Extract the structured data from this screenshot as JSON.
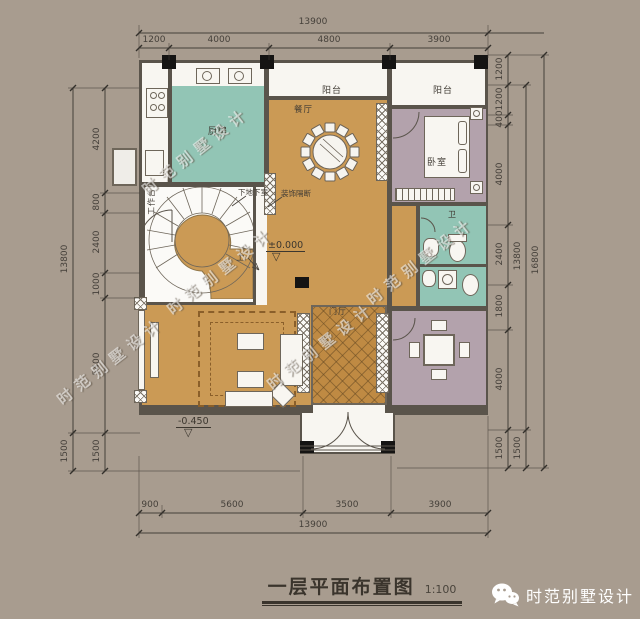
{
  "title": {
    "text": "一层平面布置图",
    "scale": "1:100"
  },
  "footer": {
    "brand": "时范别墅设计",
    "icon": "wechat-icon"
  },
  "watermark": {
    "text": "时范别墅设计"
  },
  "rooms": {
    "worktop": "工作台",
    "kitchen": "厨房",
    "dining": "餐厅",
    "balcony_top": "阳台",
    "balcony_right": "阳台",
    "bedroom": "卧室",
    "bath": "卫",
    "foyer": "门厅",
    "up": "上"
  },
  "annotations": {
    "to_basement": "下地下室",
    "partition": "装饰隔断",
    "level_zero": "±0.000",
    "level_entry": "-0.450",
    "level_symbol": "▽"
  },
  "dimensions": {
    "top": {
      "overall": "13900",
      "segments": [
        "1200",
        "4000",
        "4800",
        "3900"
      ]
    },
    "bottom": {
      "overall": "13900",
      "segments": [
        "900",
        "5600",
        "3500",
        "3900"
      ]
    },
    "left": {
      "overall": "13800",
      "porch": "1500",
      "segments": [
        "4200",
        "800",
        "2400",
        "1000",
        "5400",
        "1500"
      ]
    },
    "right": {
      "overall": "16800",
      "middle": "13800",
      "middle_porch": "1500",
      "segments": [
        "1200",
        "1200",
        "400",
        "4000",
        "2400",
        "1800",
        "4000",
        "1500"
      ]
    }
  },
  "colors": {
    "background": "#a89c8f",
    "floor": "#cb9a55",
    "wet_room": "#92c5b5",
    "soft_room": "#b3a2ac",
    "wall": "#5a544b",
    "ink": "#45403a",
    "white": "#f8f6f1"
  }
}
